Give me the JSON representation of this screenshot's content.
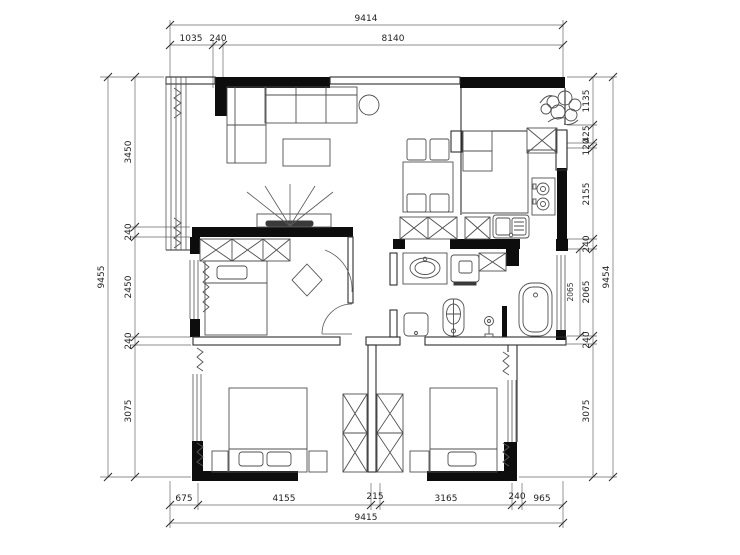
{
  "floor_plan": {
    "dim_top": {
      "total": "9414",
      "seg": [
        "1035",
        "240",
        "8140"
      ]
    },
    "dim_bottom": {
      "total": "9415",
      "seg": [
        "675",
        "4155",
        "215",
        "3165",
        "240",
        "965"
      ]
    },
    "dim_left": {
      "total": "9455",
      "seg": [
        "3450",
        "240",
        "2450",
        "240",
        "3075"
      ]
    },
    "dim_right": {
      "total": "9454",
      "seg": [
        "1135",
        "425",
        "120",
        "2155",
        "240",
        "2065",
        "240",
        "3075"
      ],
      "inner": "2065"
    }
  }
}
